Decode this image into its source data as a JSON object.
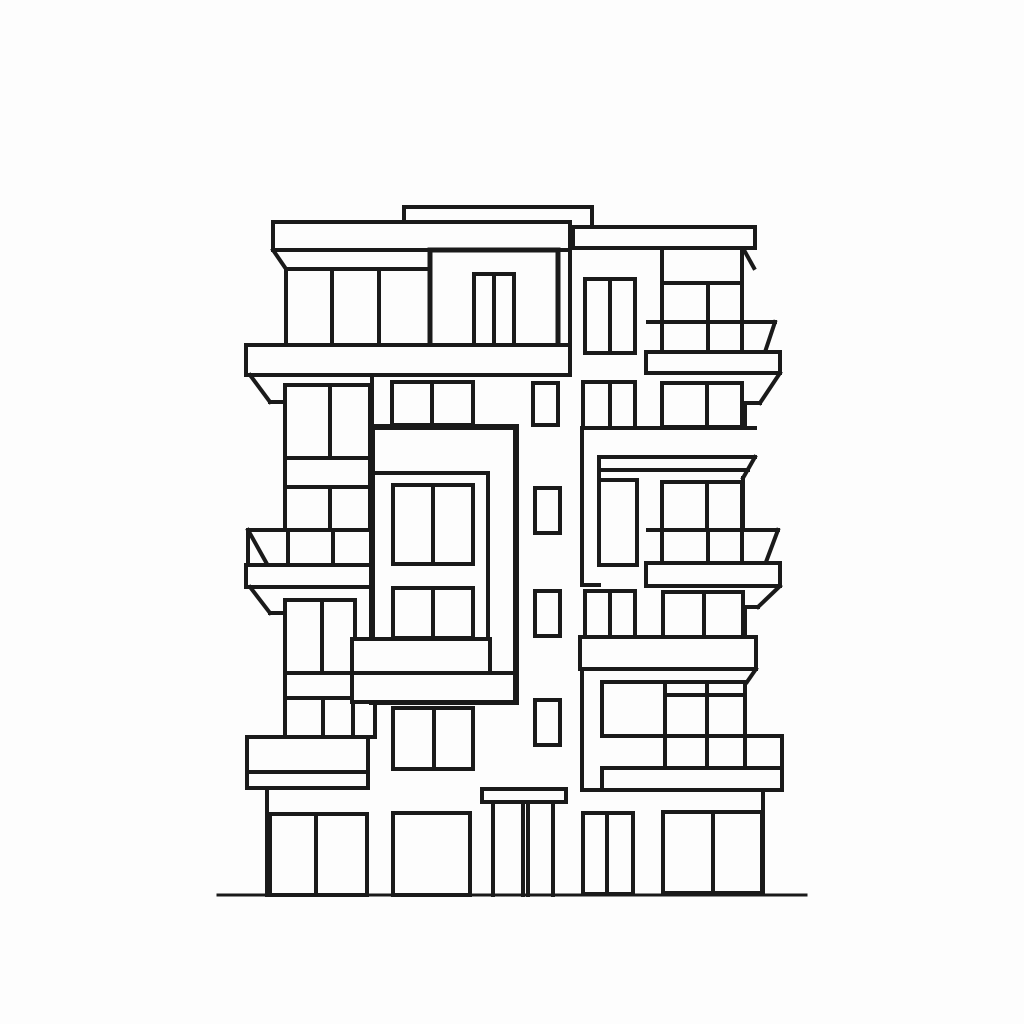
{
  "canvas": {
    "width": 1024,
    "height": 1024,
    "background": "#fdfdfd"
  },
  "style": {
    "stroke": "#1a1a1a",
    "fill": "#fdfdfd",
    "default_stroke_width": 4
  },
  "shapes": [
    [
      "r",
      "roof-parapet",
      404,
      207,
      188,
      22
    ],
    [
      "r",
      "roof-slab-right",
      573,
      227,
      182,
      21
    ],
    [
      "l",
      "roof-right-eave-diag",
      744,
      250,
      754,
      268
    ],
    [
      "r",
      "roof-slab-left",
      273,
      222,
      297,
      28
    ],
    [
      "l",
      "roof-left-eave-diag",
      273,
      250,
      286,
      269
    ],
    [
      "l",
      "floor5-left-window-top",
      286,
      269,
      430,
      269
    ],
    [
      "l",
      "floor5-left-wall-edge",
      286,
      269,
      286,
      346
    ],
    [
      "l",
      "floor5-left-mullion-1",
      332,
      269,
      332,
      345
    ],
    [
      "l",
      "floor5-left-mullion-2",
      379,
      269,
      379,
      345
    ],
    [
      "l",
      "floor5-left-window-right",
      430,
      250,
      430,
      345
    ],
    [
      "l",
      "left-tower-right-edge",
      570,
      250,
      570,
      346
    ],
    [
      "r",
      "penthouse-frame",
      430,
      250,
      128,
      97,
      5
    ],
    [
      "r",
      "penthouse-door",
      474,
      274,
      40,
      71
    ],
    [
      "l",
      "penthouse-door-mullion",
      494,
      274,
      494,
      345
    ],
    [
      "r",
      "floor5-right-twin-window",
      585,
      279,
      50,
      74
    ],
    [
      "l",
      "floor5-right-twin-mullion",
      610,
      279,
      610,
      353
    ],
    [
      "l",
      "floor5-right-wall-left",
      662,
      248,
      662,
      353
    ],
    [
      "l",
      "floor5-right-wall-right",
      742,
      248,
      742,
      353
    ],
    [
      "l",
      "floor5-right-transom",
      662,
      283,
      742,
      283
    ],
    [
      "l",
      "floor5-right-mullion",
      708,
      283,
      708,
      353
    ],
    [
      "l",
      "balcony-r1-rail-top",
      648,
      322,
      775,
      322
    ],
    [
      "l",
      "balcony-r1-corner-diag",
      775,
      322,
      765,
      352
    ],
    [
      "r",
      "balcony-r1-slab",
      646,
      352,
      134,
      21
    ],
    [
      "l",
      "balcony-r1-soffit-diag",
      780,
      373,
      760,
      403
    ],
    [
      "l",
      "balcony-r1-soffit-h",
      760,
      403,
      745,
      403
    ],
    [
      "l",
      "floor4-right-wall-edge",
      745,
      403,
      745,
      428
    ],
    [
      "r",
      "left-slab-band-1",
      246,
      345,
      324,
      30
    ],
    [
      "l",
      "balcony-l1-soffit-diag",
      250,
      375,
      270,
      402
    ],
    [
      "l",
      "balcony-l1-soffit-h",
      270,
      402,
      284,
      402
    ],
    [
      "r",
      "floor4-left-window",
      285,
      385,
      85,
      73
    ],
    [
      "l",
      "floor4-left-mullion",
      330,
      385,
      330,
      458
    ],
    [
      "r",
      "floor4-left-sill-band",
      285,
      458,
      85,
      29
    ],
    [
      "r",
      "floor3-left-window",
      285,
      487,
      85,
      43
    ],
    [
      "l",
      "floor3-left-mullion",
      330,
      487,
      330,
      530
    ],
    [
      "l",
      "balcony-l2-rail-top",
      248,
      530,
      373,
      530
    ],
    [
      "l",
      "balcony-l2-corner-diag",
      248,
      530,
      267,
      564
    ],
    [
      "l",
      "balcony-l2-left-edge",
      248,
      530,
      248,
      565
    ],
    [
      "l",
      "balcony-l2-post-1",
      288,
      530,
      288,
      565
    ],
    [
      "l",
      "balcony-l2-post-2",
      333,
      530,
      333,
      565
    ],
    [
      "l",
      "balcony-l2-right-edge",
      373,
      530,
      373,
      565
    ],
    [
      "r",
      "balcony-l2-slab",
      246,
      565,
      130,
      22
    ],
    [
      "l",
      "balcony-l2-soffit-diag",
      250,
      587,
      270,
      613
    ],
    [
      "l",
      "balcony-l2-soffit-h",
      270,
      613,
      284,
      613
    ],
    [
      "r",
      "floor2-left-window",
      285,
      600,
      70,
      73
    ],
    [
      "l",
      "floor2-left-mullion",
      322,
      600,
      322,
      673
    ],
    [
      "r",
      "floor2-left-sill-band",
      285,
      673,
      70,
      25
    ],
    [
      "r",
      "floor1-left-window",
      285,
      698,
      68,
      39
    ],
    [
      "l",
      "floor1-left-mullion",
      323,
      698,
      323,
      737
    ],
    [
      "r",
      "floor1-left-side-pane",
      353,
      700,
      22,
      37
    ],
    [
      "r",
      "balcony-l3-rail",
      247,
      737,
      121,
      35
    ],
    [
      "r",
      "balcony-l3-slab",
      247,
      772,
      121,
      16
    ],
    [
      "l",
      "groundfloor-wall-left",
      267,
      788,
      267,
      895
    ],
    [
      "r",
      "storefront-1",
      270,
      814,
      97,
      81
    ],
    [
      "l",
      "storefront-1-mullion",
      316,
      814,
      316,
      894
    ],
    [
      "r",
      "storefront-2",
      393,
      813,
      77,
      82
    ],
    [
      "r",
      "floor4-center-window",
      392,
      382,
      81,
      43
    ],
    [
      "l",
      "floor4-center-mullion",
      432,
      382,
      432,
      425
    ],
    [
      "l",
      "wall-under-slab-1",
      372,
      375,
      372,
      427
    ],
    [
      "r",
      "core-window-1",
      533,
      383,
      25,
      42
    ],
    [
      "r",
      "center-frame",
      372,
      427,
      144,
      275,
      6
    ],
    [
      "l",
      "center-frame-inner-top",
      374,
      473,
      488,
      473
    ],
    [
      "l",
      "center-frame-inner-right",
      488,
      473,
      488,
      673
    ],
    [
      "r",
      "center-frame-window-1",
      393,
      485,
      80,
      79
    ],
    [
      "l",
      "center-frame-window-1-mullion",
      433,
      485,
      433,
      564
    ],
    [
      "r",
      "center-frame-window-2",
      393,
      588,
      80,
      50
    ],
    [
      "l",
      "center-frame-window-2-mullion",
      433,
      588,
      433,
      638
    ],
    [
      "r",
      "center-slab-band",
      352,
      639,
      138,
      34
    ],
    [
      "r",
      "center-frame-bottom-bar",
      352,
      673,
      163,
      29
    ],
    [
      "r",
      "core-window-2",
      535,
      488,
      25,
      45
    ],
    [
      "r",
      "core-window-3",
      535,
      591,
      25,
      45
    ],
    [
      "r",
      "core-window-4",
      535,
      700,
      25,
      45
    ],
    [
      "r",
      "floor1-center-twin-window",
      393,
      708,
      80,
      61
    ],
    [
      "l",
      "floor1-center-mullion",
      434,
      708,
      434,
      769
    ],
    [
      "r",
      "entrance-canopy",
      482,
      789,
      84,
      13
    ],
    [
      "l",
      "entrance-post-1",
      493,
      802,
      493,
      895
    ],
    [
      "l",
      "entrance-post-2",
      523,
      802,
      523,
      895
    ],
    [
      "l",
      "entrance-post-3",
      528,
      802,
      528,
      895
    ],
    [
      "l",
      "entrance-post-4",
      553,
      802,
      553,
      895
    ],
    [
      "r",
      "floor4-right-twin-window",
      583,
      382,
      52,
      46
    ],
    [
      "l",
      "floor4-right-twin-mullion",
      610,
      382,
      610,
      428
    ],
    [
      "r",
      "floor4-right-window",
      662,
      383,
      80,
      44
    ],
    [
      "l",
      "floor4-right-window-mullion",
      707,
      383,
      707,
      427
    ],
    [
      "l",
      "floor4-right-sill-line",
      582,
      428,
      755,
      428
    ],
    [
      "l",
      "right-tower-wall-left",
      582,
      428,
      582,
      585
    ],
    [
      "l",
      "right-tower-wall-left-foot",
      582,
      585,
      599,
      585
    ],
    [
      "l",
      "right-header-band-top",
      599,
      457,
      755,
      457
    ],
    [
      "l",
      "right-header-band-bottom",
      599,
      470,
      748,
      470
    ],
    [
      "l",
      "right-header-band-diag",
      755,
      457,
      743,
      478
    ],
    [
      "l",
      "right-header-band-left",
      599,
      457,
      599,
      480
    ],
    [
      "r",
      "floor3-right-tall-window",
      599,
      480,
      38,
      85
    ],
    [
      "r",
      "floor3-right-window",
      662,
      482,
      80,
      48
    ],
    [
      "l",
      "floor3-right-window-mullion",
      707,
      482,
      707,
      530
    ],
    [
      "l",
      "floor3-right-wall-edge",
      743,
      478,
      743,
      530
    ],
    [
      "l",
      "balcony-r2-rail-top",
      648,
      530,
      778,
      530
    ],
    [
      "l",
      "balcony-r2-corner-diag",
      778,
      530,
      766,
      562
    ],
    [
      "l",
      "balcony-r2-post-1",
      662,
      530,
      662,
      563
    ],
    [
      "l",
      "balcony-r2-post-2",
      708,
      530,
      708,
      563
    ],
    [
      "l",
      "balcony-r2-post-3",
      742,
      530,
      742,
      563
    ],
    [
      "r",
      "balcony-r2-slab",
      646,
      563,
      134,
      23
    ],
    [
      "l",
      "balcony-r2-soffit-diag",
      780,
      586,
      758,
      607
    ],
    [
      "l",
      "balcony-r2-soffit-h",
      758,
      607,
      745,
      607
    ],
    [
      "l",
      "floor2-right-wall-edge",
      745,
      607,
      745,
      637
    ],
    [
      "r",
      "floor2-right-twin-window",
      585,
      591,
      50,
      46
    ],
    [
      "l",
      "floor2-right-twin-mullion",
      610,
      591,
      610,
      637
    ],
    [
      "r",
      "floor2-right-window",
      663,
      592,
      80,
      45
    ],
    [
      "l",
      "floor2-right-window-mullion",
      704,
      592,
      704,
      637
    ],
    [
      "r",
      "right-slab-band",
      580,
      637,
      176,
      32
    ],
    [
      "l",
      "right-slab-band-diag",
      756,
      669,
      747,
      682
    ],
    [
      "l",
      "right-tower-lower-wall-left",
      582,
      669,
      582,
      790
    ],
    [
      "r",
      "floor1-right-window-grid",
      602,
      682,
      143,
      54
    ],
    [
      "l",
      "floor1-right-grid-transom",
      665,
      695,
      745,
      695
    ],
    [
      "l",
      "floor1-right-grid-v1",
      665,
      682,
      665,
      736
    ],
    [
      "l",
      "floor1-right-grid-v2",
      707,
      682,
      707,
      736
    ],
    [
      "l",
      "balcony-r3-rail-top-ext",
      745,
      736,
      782,
      736
    ],
    [
      "l",
      "balcony-r3-post-1",
      665,
      736,
      665,
      768
    ],
    [
      "l",
      "balcony-r3-post-2",
      707,
      736,
      707,
      768
    ],
    [
      "l",
      "balcony-r3-post-3",
      745,
      736,
      745,
      768
    ],
    [
      "l",
      "balcony-r3-right-edge",
      782,
      736,
      782,
      768
    ],
    [
      "r",
      "balcony-r3-slab",
      602,
      768,
      180,
      22
    ],
    [
      "l",
      "groundfloor-wall-line",
      582,
      790,
      604,
      790
    ],
    [
      "r",
      "storefront-3-twin",
      583,
      813,
      50,
      81
    ],
    [
      "l",
      "storefront-3-mullion",
      607,
      813,
      607,
      893
    ],
    [
      "r",
      "storefront-4",
      663,
      812,
      99,
      81
    ],
    [
      "l",
      "storefront-4-mullion",
      713,
      812,
      713,
      892
    ],
    [
      "l",
      "groundfloor-wall-right",
      763,
      790,
      763,
      893
    ],
    [
      "l",
      "ground-line",
      218,
      895,
      806,
      895,
      3
    ]
  ]
}
